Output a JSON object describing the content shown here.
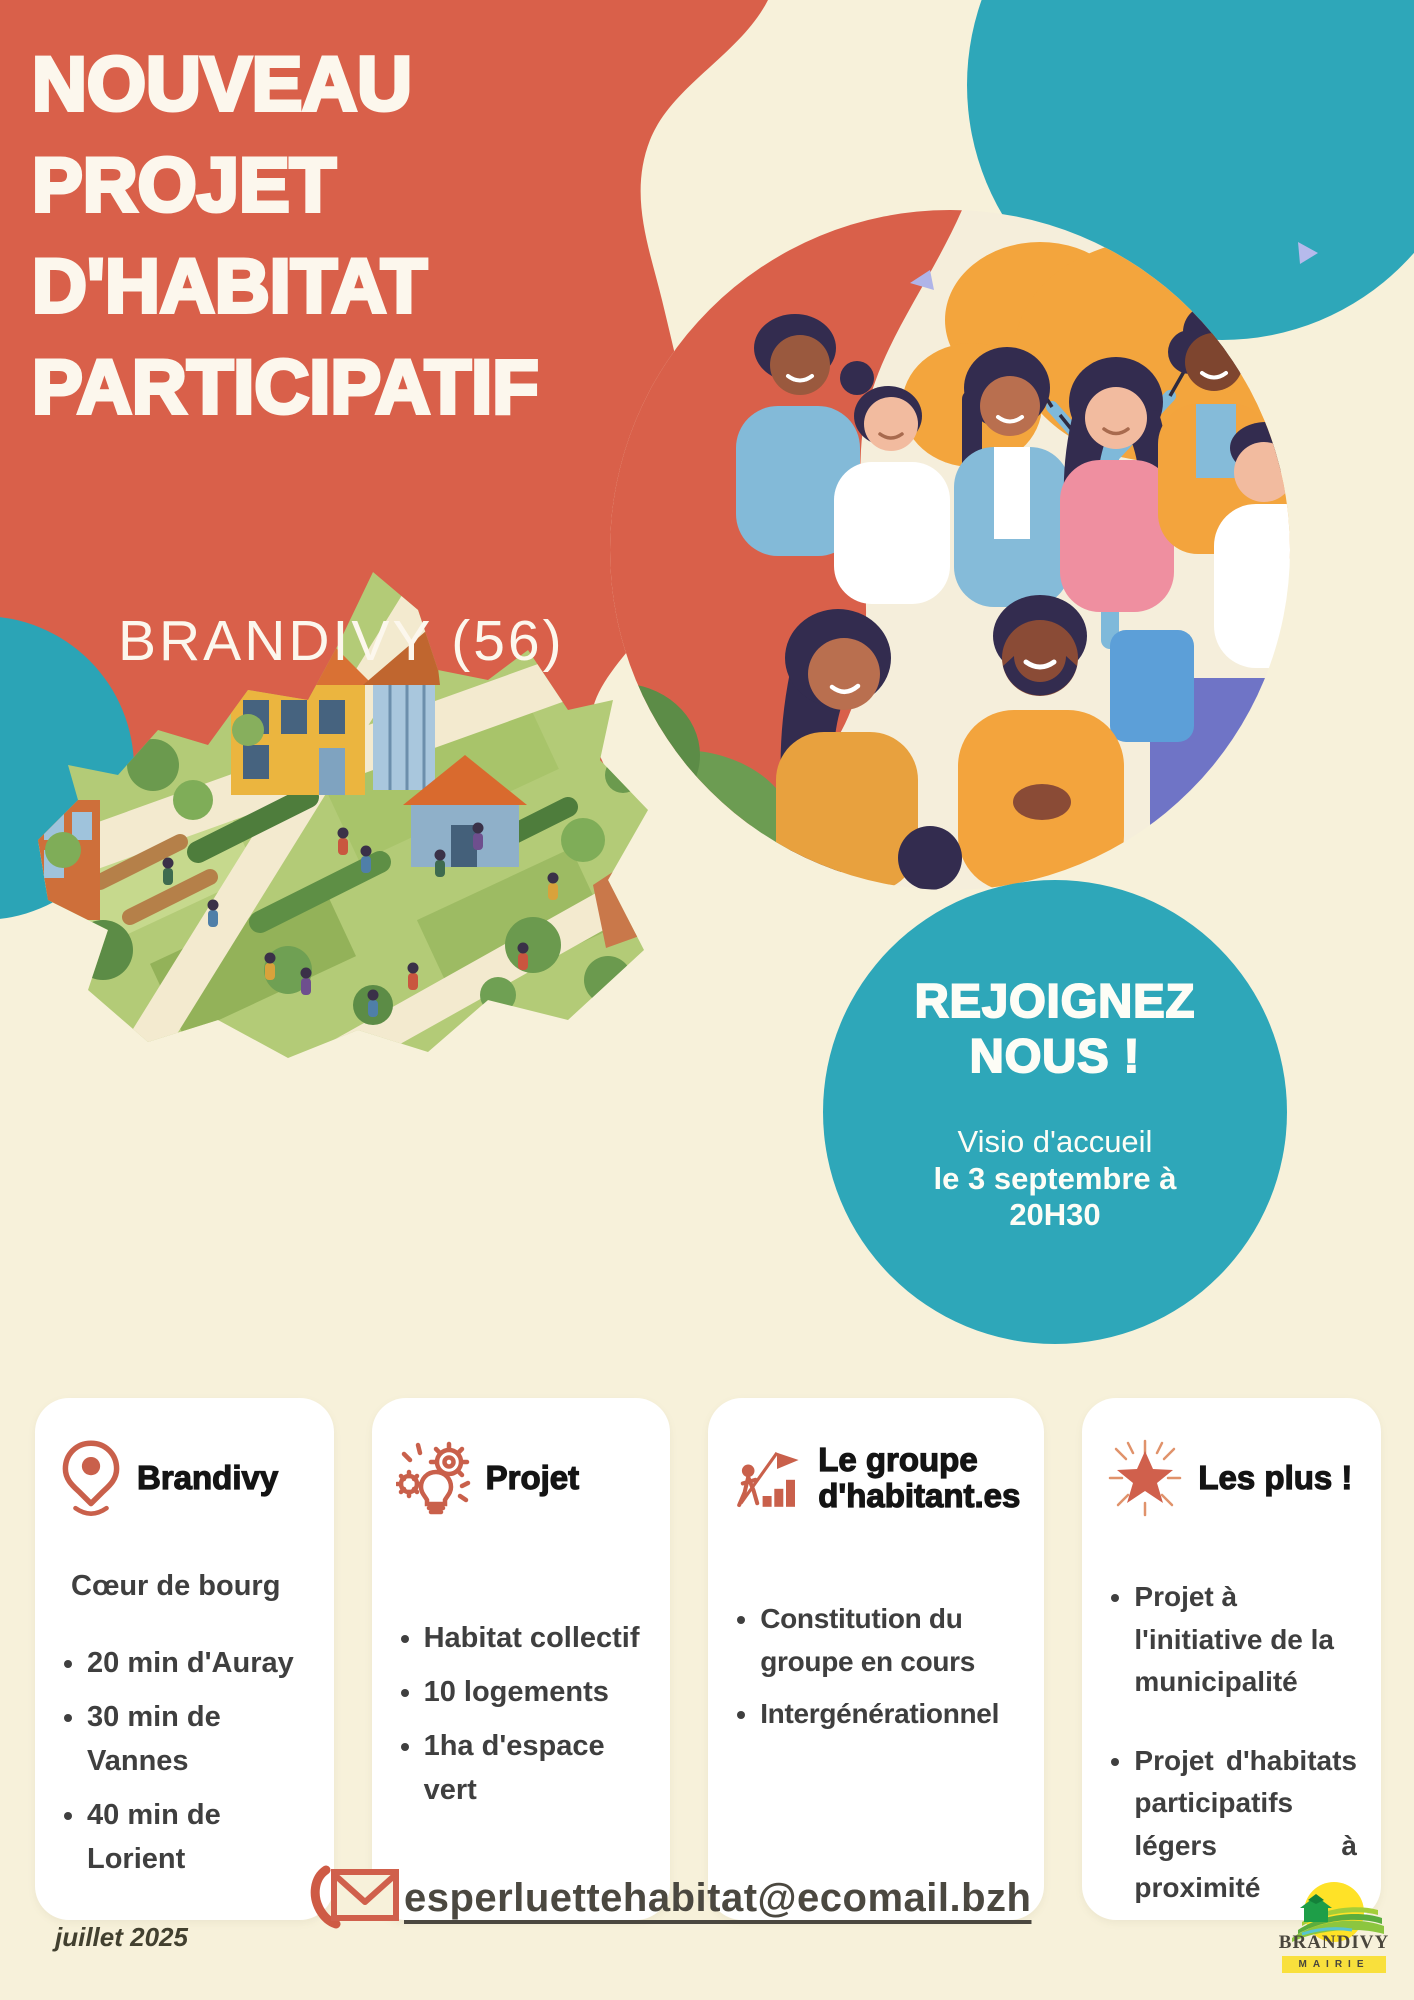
{
  "poster": {
    "title_lines": [
      "NOUVEAU",
      "PROJET",
      "D'HABITAT",
      "PARTICIPATIF"
    ],
    "location": "BRANDIVY (56)",
    "join_circle": {
      "title_line1": "REJOIGNEZ",
      "title_line2": "NOUS !",
      "event_line1": "Visio d'accueil",
      "event_line2": "le 3 septembre à",
      "event_line3": "20H30"
    },
    "cards": [
      {
        "icon": "location-pin-icon",
        "title": "Brandivy",
        "intro": "Cœur de bourg",
        "bullets": [
          "20 min d'Auray",
          "30 min de Vannes",
          "40 min de Lorient"
        ]
      },
      {
        "icon": "idea-gears-icon",
        "title": "Projet",
        "bullets": [
          "Habitat collectif",
          "10 logements",
          "1ha d'espace vert"
        ]
      },
      {
        "icon": "growth-chart-icon",
        "title": "Le groupe d'habitant.es",
        "bullets": [
          "Constitution du groupe en cours",
          "Intergénérationnel"
        ]
      },
      {
        "icon": "star-icon",
        "title": "Les plus !",
        "bullets": [
          "Projet à l'initiative de la municipalité",
          "Projet d'habitats participatifs légers à proximité"
        ]
      }
    ],
    "contact_email": "esperluettehabitat@ecomail.bzh",
    "date_note": "juillet 2025",
    "logo": {
      "name": "BRANDIVY",
      "sub": "MAIRIE"
    },
    "colors": {
      "coral": "#D9604A",
      "teal": "#2EA7B9",
      "cream": "#F7F1DA",
      "text_dark": "#3F3F3F"
    }
  }
}
